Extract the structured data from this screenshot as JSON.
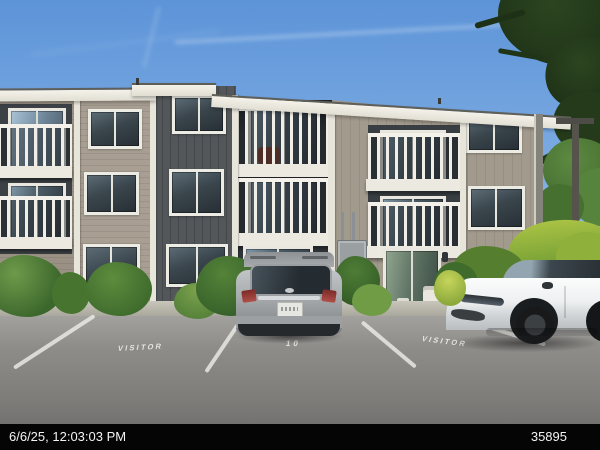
{
  "overlay": {
    "timestamp": "6/6/25, 12:03:03 PM",
    "photo_number": "35895"
  },
  "pavement": {
    "left_marking": "VISITOR",
    "center_marking": "10",
    "right_marking": "VISITOR"
  },
  "palette": {
    "sky_top": "#5d94d8",
    "sky_bottom": "#b3cfee",
    "siding_light": "#a89f92",
    "siding_dark": "#53575a",
    "recess_dark": "#2f3438",
    "trim_white": "#eeebe2",
    "asphalt": "#8e8c89",
    "curb": "#bdbab0",
    "suv_silver": "#aaadb0",
    "sedan_white": "#f0f1f2",
    "foliage_dark": "#223619",
    "foliage_mid": "#4f7d36",
    "foliage_bright": "#a5bf45",
    "overlay_bar": "#050505",
    "overlay_text": "#f3f3f3"
  }
}
